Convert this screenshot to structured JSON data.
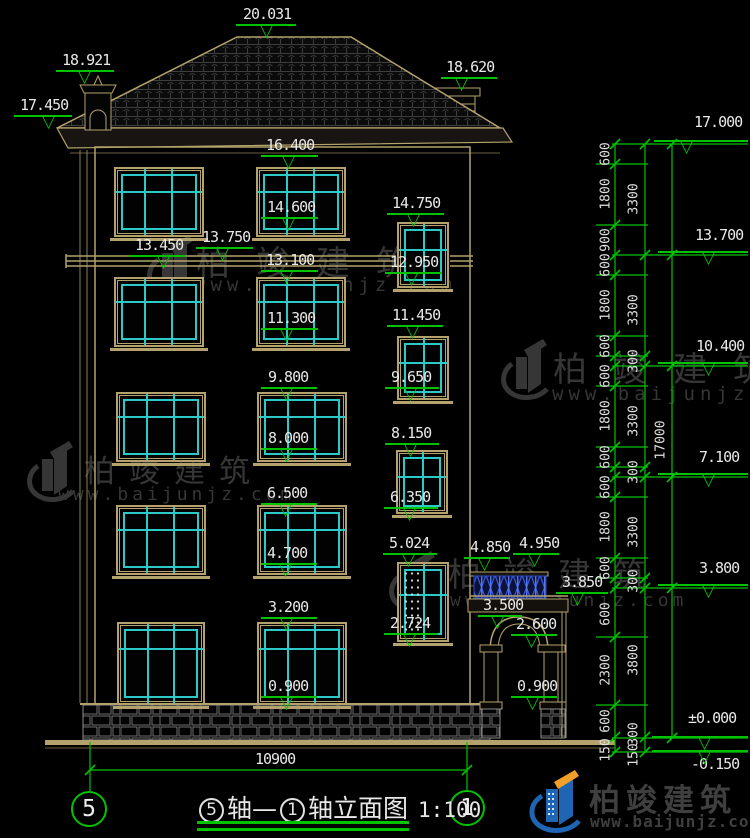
{
  "colors": {
    "background": "#000000",
    "dim_green": "#00c300",
    "line_tan": "#b3a26b",
    "window_cyan": "#2cc9c9",
    "watermark_gray": "#363636",
    "text_white": "#e8e8e8",
    "balustrade_blue": "#3c5ce0",
    "brand_blue": "#1e66b4",
    "brand_orange": "#f0a028"
  },
  "watermark": {
    "title": "柏竣建筑",
    "url": "www.baijunjz.com",
    "items": [
      {
        "lx": 146,
        "ly": 234,
        "tx": 196,
        "ty": 236,
        "ux": 194,
        "uy": 274,
        "ts": 34,
        "tls": 26,
        "us": 19,
        "uls": 5
      },
      {
        "lx": 500,
        "ly": 338,
        "tx": 553,
        "ty": 342,
        "ux": 552,
        "uy": 383,
        "ts": 34,
        "tls": 26,
        "us": 19,
        "uls": 5
      },
      {
        "lx": 26,
        "ly": 440,
        "tx": 84,
        "ty": 446,
        "ux": 58,
        "uy": 484,
        "ts": 31,
        "tls": 14,
        "us": 18,
        "uls": 4
      },
      {
        "lx": 388,
        "ly": 550,
        "tx": 448,
        "ty": 548,
        "ux": 450,
        "uy": 590,
        "ts": 33,
        "tls": 22,
        "us": 18,
        "uls": 4
      }
    ]
  },
  "brand": {
    "title": "柏竣建筑",
    "url": "www.baijunjz.com"
  },
  "title_block": {
    "axis_a": "5",
    "mid": "轴—",
    "axis_b": "1",
    "suffix": "轴立面图",
    "scale": "1:100",
    "dim": "10900",
    "axis_left": "5",
    "axis_right": "1"
  },
  "dims": {
    "elevation_labels": [
      {
        "t": "20.031",
        "x": 243,
        "y": 6,
        "lx": 236,
        "lw": 60,
        "vx": 268
      },
      {
        "t": "18.921",
        "x": 62,
        "y": 52,
        "lx": 56,
        "lw": 58,
        "vx": 86
      },
      {
        "t": "17.450",
        "x": 20,
        "y": 97,
        "lx": 14,
        "lw": 58,
        "vx": 50
      },
      {
        "t": "18.620",
        "x": 446,
        "y": 59,
        "lx": 441,
        "lw": 56,
        "vx": 463
      },
      {
        "t": "16.400",
        "x": 266,
        "y": 137,
        "lx": 261,
        "lw": 57,
        "vx": 290
      },
      {
        "t": "14.600",
        "x": 267,
        "y": 199,
        "lx": 261,
        "lw": 57,
        "vx": 290
      },
      {
        "t": "14.750",
        "x": 392,
        "y": 195,
        "lx": 387,
        "lw": 57,
        "vx": 415
      },
      {
        "t": "12.950",
        "x": 390,
        "y": 254,
        "lx": 385,
        "lw": 57,
        "vx": 413
      },
      {
        "t": "13.450",
        "x": 135,
        "y": 237,
        "lx": 129,
        "lw": 57,
        "vx": 165
      },
      {
        "t": "13.750",
        "x": 202,
        "y": 229,
        "lx": 196,
        "lw": 57,
        "vx": 224
      },
      {
        "t": "13.100",
        "x": 266,
        "y": 252,
        "lx": 261,
        "lw": 57,
        "vx": 288
      },
      {
        "t": "11.300",
        "x": 267,
        "y": 310,
        "lx": 261,
        "lw": 57,
        "vx": 288
      },
      {
        "t": "11.450",
        "x": 392,
        "y": 307,
        "lx": 387,
        "lw": 56,
        "vx": 414
      },
      {
        "t": "9.650",
        "x": 391,
        "y": 369,
        "lx": 385,
        "lw": 54,
        "vx": 412
      },
      {
        "t": "9.800",
        "x": 268,
        "y": 369,
        "lx": 261,
        "lw": 56,
        "vx": 288
      },
      {
        "t": "8.000",
        "x": 268,
        "y": 430,
        "lx": 261,
        "lw": 56,
        "vx": 288
      },
      {
        "t": "8.150",
        "x": 391,
        "y": 425,
        "lx": 385,
        "lw": 54,
        "vx": 412
      },
      {
        "t": "6.350",
        "x": 390,
        "y": 489,
        "lx": 384,
        "lw": 54,
        "vx": 411
      },
      {
        "t": "6.500",
        "x": 267,
        "y": 485,
        "lx": 261,
        "lw": 56,
        "vx": 287
      },
      {
        "t": "4.700",
        "x": 267,
        "y": 545,
        "lx": 261,
        "lw": 56,
        "vx": 287
      },
      {
        "t": "5.024",
        "x": 389,
        "y": 535,
        "lx": 383,
        "lw": 54,
        "vx": 410
      },
      {
        "t": "2.724",
        "x": 390,
        "y": 615,
        "lx": 384,
        "lw": 54,
        "vx": 411
      },
      {
        "t": "3.200",
        "x": 268,
        "y": 599,
        "lx": 261,
        "lw": 56,
        "vx": 288
      },
      {
        "t": "0.900",
        "x": 268,
        "y": 678,
        "lx": 261,
        "lw": 56,
        "vx": 288
      },
      {
        "t": "4.850",
        "x": 470,
        "y": 539,
        "lx": 464,
        "lw": 46,
        "vx": 486
      },
      {
        "t": "4.950",
        "x": 519,
        "y": 535,
        "lx": 513,
        "lw": 46,
        "vx": 536
      },
      {
        "t": "3.850",
        "x": 562,
        "y": 574,
        "lx": 556,
        "lw": 52,
        "vx": 579
      },
      {
        "t": "3.500",
        "x": 483,
        "y": 597,
        "lx": 478,
        "lw": 44,
        "vx": 499
      },
      {
        "t": "2.600",
        "x": 516,
        "y": 616,
        "lx": 511,
        "lw": 46,
        "vx": 533
      },
      {
        "t": "0.900",
        "x": 517,
        "y": 678,
        "lx": 511,
        "lw": 46,
        "vx": 534
      }
    ],
    "right_levels": [
      {
        "t": "17.000",
        "x": 694,
        "y": 114,
        "lx": 654,
        "lw": 94,
        "ly": 140,
        "vx": 688
      },
      {
        "t": "13.700",
        "x": 695,
        "y": 227,
        "lx": 658,
        "lw": 90,
        "ly": 251,
        "vx": 710
      },
      {
        "t": "10.400",
        "x": 696,
        "y": 338,
        "lx": 658,
        "lw": 90,
        "ly": 362,
        "vx": 710
      },
      {
        "t": "7.100",
        "x": 699,
        "y": 449,
        "lx": 658,
        "lw": 90,
        "ly": 473,
        "vx": 710
      },
      {
        "t": "3.800",
        "x": 699,
        "y": 560,
        "lx": 658,
        "lw": 90,
        "ly": 584,
        "vx": 710
      },
      {
        "t": "±0.000",
        "x": 688,
        "y": 710,
        "lx": 652,
        "lw": 96,
        "ly": 736,
        "vx": 706
      },
      {
        "t": "-0.150",
        "x": 691,
        "y": 756,
        "lx": 652,
        "lw": 96,
        "ly": 750,
        "vx": 706
      }
    ],
    "chain_labels": {
      "lane1": [
        {
          "t": "600",
          "y": 154
        },
        {
          "t": "1800",
          "y": 194
        },
        {
          "t": "900",
          "y": 240
        },
        {
          "t": "600",
          "y": 265
        },
        {
          "t": "1800",
          "y": 305
        },
        {
          "t": "600",
          "y": 346
        },
        {
          "t": "600",
          "y": 376
        },
        {
          "t": "1800",
          "y": 416
        },
        {
          "t": "600",
          "y": 457
        },
        {
          "t": "600",
          "y": 487
        },
        {
          "t": "1800",
          "y": 527
        },
        {
          "t": "600",
          "y": 568
        },
        {
          "t": "600",
          "y": 614
        },
        {
          "t": "2300",
          "y": 670
        },
        {
          "t": "600",
          "y": 721
        },
        {
          "t": "150",
          "y": 750
        }
      ],
      "lane2": [
        {
          "t": "3300",
          "y": 199
        },
        {
          "t": "3300",
          "y": 310
        },
        {
          "t": "300",
          "y": 361
        },
        {
          "t": "3300",
          "y": 421
        },
        {
          "t": "300",
          "y": 472
        },
        {
          "t": "3300",
          "y": 532
        },
        {
          "t": "300",
          "y": 581
        },
        {
          "t": "3800",
          "y": 660
        },
        {
          "t": "300",
          "y": 734
        },
        {
          "t": "150",
          "y": 755
        }
      ],
      "lane3": [
        {
          "t": "17000",
          "y": 440
        }
      ]
    },
    "chain_x": [
      615,
      645,
      672
    ],
    "lane_x": [
      606,
      634,
      661
    ],
    "ticks1": [
      144,
      164,
      225,
      255,
      275,
      336,
      356,
      366,
      386,
      447,
      467,
      477,
      497,
      558,
      578,
      588,
      637,
      705,
      737,
      752
    ],
    "ticks2": [
      144,
      255,
      356,
      366,
      467,
      477,
      578,
      588,
      737,
      752
    ],
    "ticks3": [
      144,
      255,
      366,
      477,
      588,
      738
    ],
    "major_lines": [
      144,
      255,
      366,
      477,
      588,
      738,
      752
    ],
    "minor_lines": [
      164,
      225,
      275,
      336,
      356,
      386,
      447,
      467,
      497,
      558,
      578,
      637,
      705
    ],
    "bottom_dim": {
      "y": 770,
      "x1": 90,
      "x2": 467,
      "tx": 257,
      "ty": 751
    }
  },
  "drawing": {
    "windows": [
      {
        "x": 114,
        "y": 167,
        "w": 90,
        "h": 70,
        "s": "w3"
      },
      {
        "x": 256,
        "y": 167,
        "w": 90,
        "h": 70,
        "s": "w3"
      },
      {
        "x": 114,
        "y": 277,
        "w": 90,
        "h": 70,
        "s": "w3"
      },
      {
        "x": 256,
        "y": 277,
        "w": 90,
        "h": 70,
        "s": "w3"
      },
      {
        "x": 116,
        "y": 392,
        "w": 90,
        "h": 70,
        "s": "w3"
      },
      {
        "x": 257,
        "y": 392,
        "w": 90,
        "h": 70,
        "s": "w3"
      },
      {
        "x": 116,
        "y": 505,
        "w": 90,
        "h": 70,
        "s": "w3"
      },
      {
        "x": 257,
        "y": 505,
        "w": 90,
        "h": 70,
        "s": "w3"
      },
      {
        "x": 117,
        "y": 622,
        "w": 88,
        "h": 83,
        "s": "w3t"
      },
      {
        "x": 257,
        "y": 622,
        "w": 90,
        "h": 83,
        "s": "w3t"
      },
      {
        "x": 397,
        "y": 222,
        "w": 52,
        "h": 66,
        "s": "w2"
      },
      {
        "x": 397,
        "y": 336,
        "w": 52,
        "h": 64,
        "s": "w2"
      },
      {
        "x": 396,
        "y": 450,
        "w": 52,
        "h": 64,
        "s": "w2"
      },
      {
        "x": 397,
        "y": 562,
        "w": 52,
        "h": 80,
        "s": "w2d"
      }
    ]
  }
}
